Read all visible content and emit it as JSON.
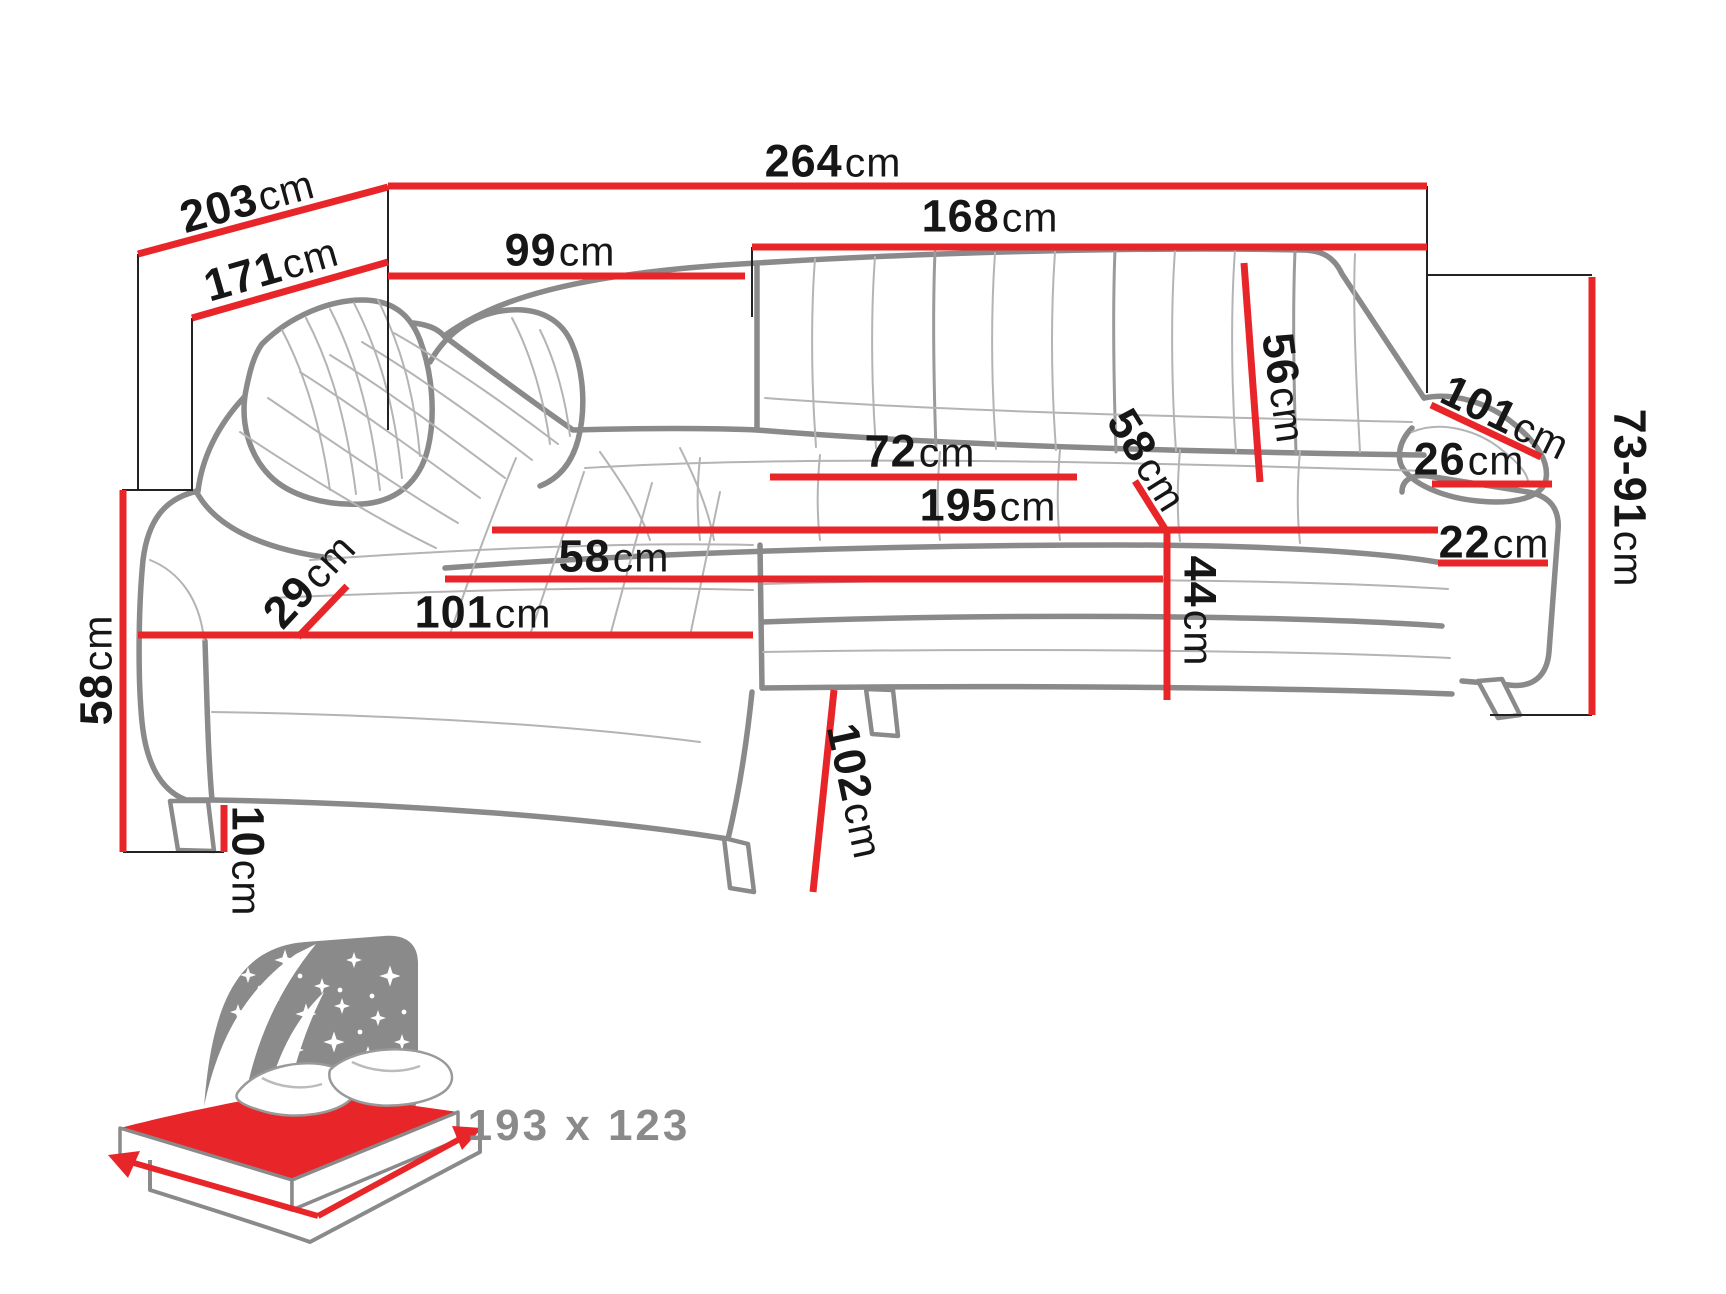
{
  "diagram_type": "corner-sofa dimension drawing",
  "colors": {
    "dimension_line": "#e8262a",
    "sofa_outline": "#8a8a8a",
    "label_text": "#161616",
    "bed_icon_gray": "#8a8a8a"
  },
  "measurements": {
    "total_width": {
      "value": "264",
      "unit": "cm"
    },
    "total_depth": {
      "value": "203",
      "unit": "cm"
    },
    "inner_depth": {
      "value": "171",
      "unit": "cm"
    },
    "back_section_left": {
      "value": "99",
      "unit": "cm"
    },
    "back_section_right": {
      "value": "168",
      "unit": "cm"
    },
    "backrest_height": {
      "value": "56",
      "unit": "cm"
    },
    "armrest_length": {
      "value": "101",
      "unit": "cm"
    },
    "armrest_top_width": {
      "value": "26",
      "unit": "cm"
    },
    "height_range": {
      "value": "73-91",
      "unit": "cm"
    },
    "backrest_width": {
      "value": "72",
      "unit": "cm"
    },
    "seat_depth_diag": {
      "value": "58",
      "unit": "cm"
    },
    "seat_width": {
      "value": "195",
      "unit": "cm"
    },
    "armrest_front_height": {
      "value": "22",
      "unit": "cm"
    },
    "chaise_seat_width": {
      "value": "58",
      "unit": "cm"
    },
    "corner_seat_depth": {
      "value": "29",
      "unit": "cm"
    },
    "chaise_length": {
      "value": "101",
      "unit": "cm"
    },
    "seat_height": {
      "value": "44",
      "unit": "cm"
    },
    "side_height": {
      "value": "58",
      "unit": "cm"
    },
    "leg_height": {
      "value": "10",
      "unit": "cm"
    },
    "chaise_total_depth": {
      "value": "102",
      "unit": "cm"
    },
    "sleeping_area": {
      "value": "193 x 123",
      "unit": ""
    }
  }
}
